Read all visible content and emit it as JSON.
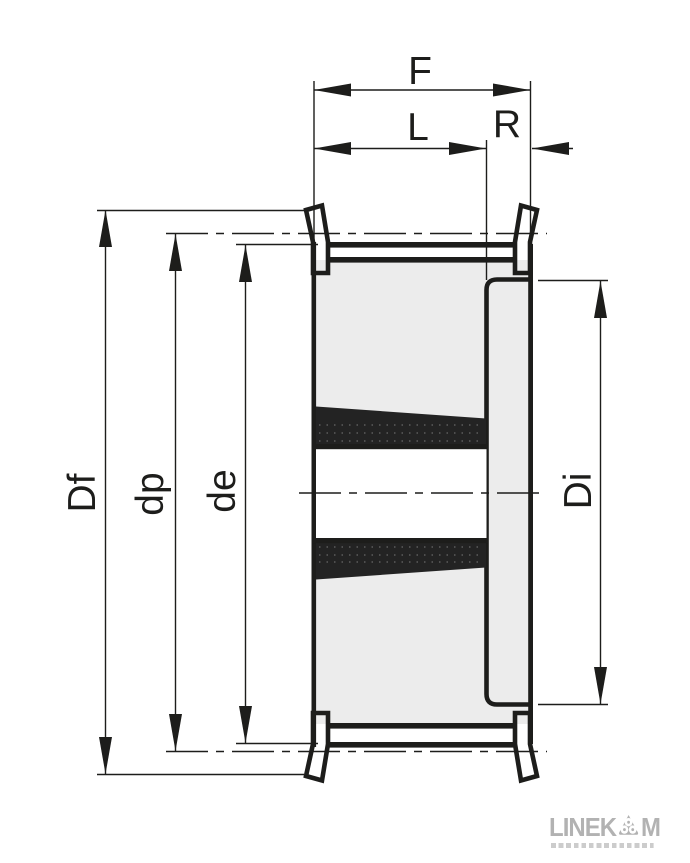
{
  "title": "Timing belt pulley with taper bush - cross-section dimension drawing",
  "dimension_labels": {
    "total_width": "F",
    "belt_width": "L",
    "recess_depth": "R",
    "flange_diameter": "Df",
    "pitch_diameter": "dp",
    "outside_diameter": "de",
    "recess_diameter": "Di"
  },
  "logo": {
    "text_before_icon": "LINEK",
    "text_after_icon": "M",
    "icon": "pulley-rollers-icon"
  },
  "colors": {
    "line": "#1d1d1b",
    "body_fill": "#ececec",
    "flange_fill": "#d8d8d8",
    "bush_fill": "#232323",
    "bore_fill": "#ffffff",
    "logo": "#b2b2b2",
    "background": "#ffffff"
  }
}
